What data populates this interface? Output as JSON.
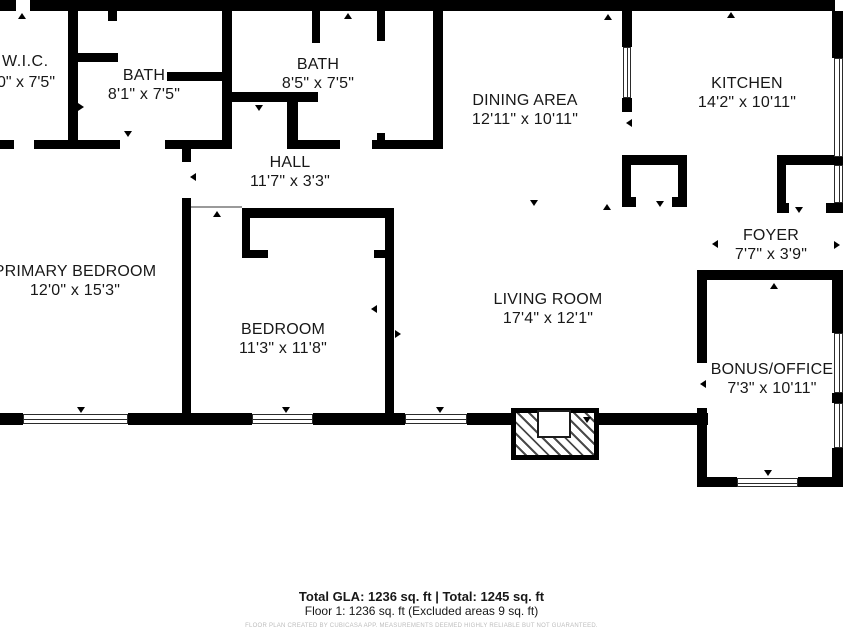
{
  "floor_plan": {
    "rooms": {
      "wic": {
        "name": "W.I.C.",
        "dims": "10\" x 7'5\""
      },
      "bath_a": {
        "name": "BATH",
        "dims": "8'1\" x 7'5\""
      },
      "bath_b": {
        "name": "BATH",
        "dims": "8'5\" x 7'5\""
      },
      "hall": {
        "name": "HALL",
        "dims": "11'7\" x 3'3\""
      },
      "dining": {
        "name": "DINING AREA",
        "dims": "12'11\" x 10'11\""
      },
      "kitchen": {
        "name": "KITCHEN",
        "dims": "14'2\" x 10'11\""
      },
      "primary": {
        "name": "PRIMARY BEDROOM",
        "dims": "12'0\" x 15'3\""
      },
      "bedroom": {
        "name": "BEDROOM",
        "dims": "11'3\" x 11'8\""
      },
      "living": {
        "name": "LIVING ROOM",
        "dims": "17'4\" x 12'1\""
      },
      "foyer": {
        "name": "FOYER",
        "dims": "7'7\" x 3'9\""
      },
      "bonus": {
        "name": "BONUS/OFFICE",
        "dims": "7'3\" x 10'11\""
      }
    },
    "footer": {
      "totals": "Total GLA: 1236 sq. ft | Total: 1245 sq. ft",
      "floor_breakdown": "Floor 1: 1236 sq. ft (Excluded areas 9 sq. ft)",
      "disclaimer": "FLOOR PLAN CREATED BY CUBICASA APP. MEASUREMENTS DEEMED HIGHLY RELIABLE BUT NOT GUARANTEED."
    },
    "colors": {
      "wall": "#000000",
      "background": "#ffffff",
      "disclaimer_text": "#bcbcbc"
    }
  }
}
